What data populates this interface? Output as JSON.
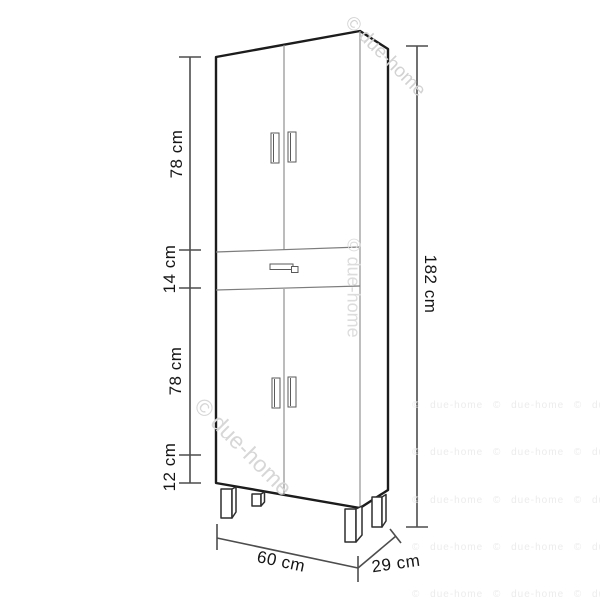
{
  "diagram": {
    "labels": {
      "upper_section": "78 cm",
      "drawer_section": "14 cm",
      "lower_section": "78 cm",
      "legs_section": "12 cm",
      "total_height": "182 cm",
      "width": "60 cm",
      "depth": "29 cm"
    },
    "watermark": {
      "text": "© due-home",
      "tile_text": "© due-home © due-home © due-home",
      "color": "#d7d7d7"
    }
  }
}
